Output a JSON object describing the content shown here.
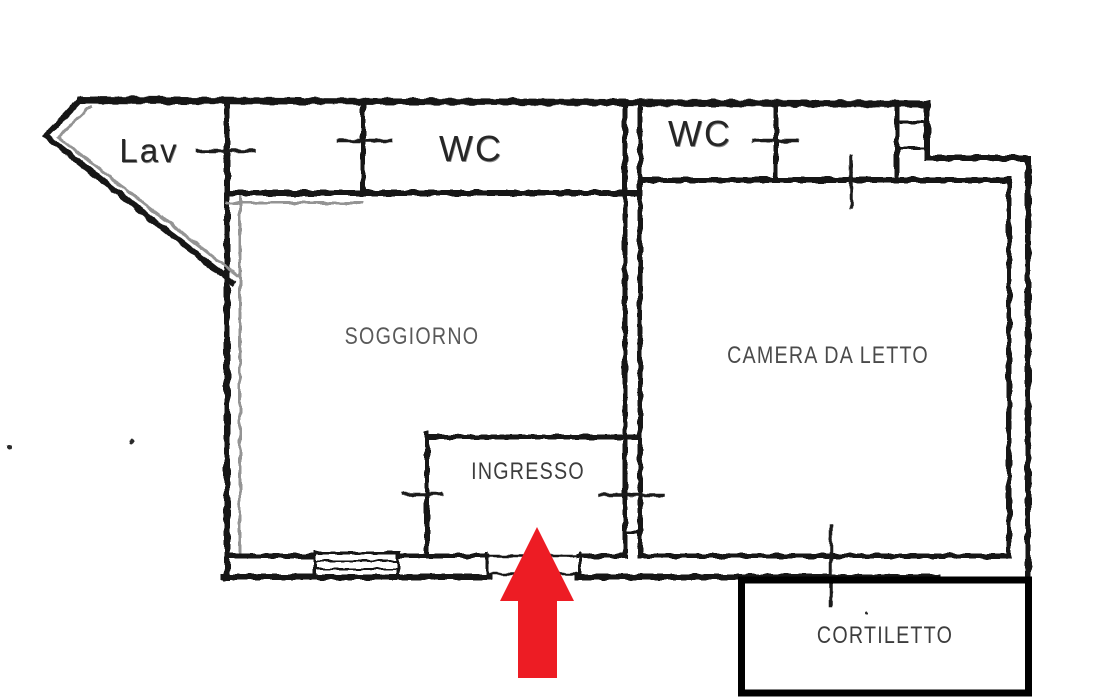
{
  "plan": {
    "rooms": {
      "lav": "Lav",
      "wc_left": "WC",
      "wc_right": "WC",
      "soggiorno": "SOGGIORNO",
      "camera_da_letto": "CAMERA DA LETTO",
      "ingresso": "INGRESSO",
      "cortiletto": "CORTILETTO"
    },
    "annotations": {
      "entrance_arrow": "up-arrow marking main entrance at bottom of INGRESSO"
    },
    "colors": {
      "wall_black": "#161616",
      "wall_gray": "#949494",
      "wall_faint": "#b5b5b5",
      "cortiletto_border": "#000000",
      "arrow_red": "#ed1c24",
      "room_label_text": "#4d4d4d",
      "scan_label_text": "#262626",
      "background": "#ffffff"
    }
  }
}
